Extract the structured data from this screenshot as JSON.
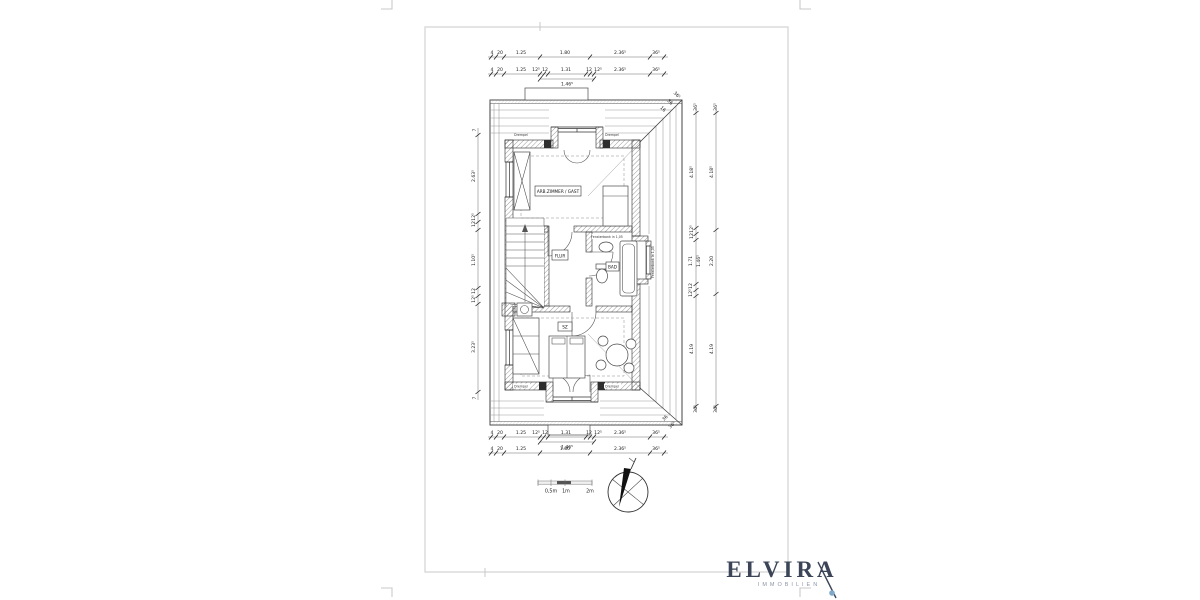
{
  "plan": {
    "rooms": {
      "study": "ARB.ZIMMER / GAST",
      "hall": "FLUR",
      "bath": "BAD",
      "bedroom": "SZ"
    },
    "notes": {
      "sill_top": "Fensterbank in 1,05",
      "sill_right": "Fensterbank in 1,05",
      "knee_top_left": "Drempel",
      "knee_top_right": "Drempel",
      "knee_bottom_left": "Drempel",
      "knee_bottom_right": "Drempel"
    },
    "dims": {
      "top_outer": [
        "4",
        "20",
        "1.25",
        "1.80",
        "2.36⁵",
        "36⁵"
      ],
      "top_inner": [
        "4",
        "20",
        "1.25",
        "12⁵",
        "12",
        "1.31",
        "12",
        "12⁵",
        "2.36⁵",
        "36⁵"
      ],
      "top_sub": "1.46⁵",
      "bottom_inner": [
        "4",
        "20",
        "1.25",
        "12⁵",
        "12",
        "1.31",
        "12",
        "12⁵",
        "2.36⁵",
        "36⁵"
      ],
      "bottom_sub": "1.46⁵",
      "bottom_outer": [
        "4",
        "20",
        "1.25",
        "1.80",
        "2.36⁵",
        "36⁵"
      ],
      "left": [
        "7",
        "2.63⁵",
        "12⁵",
        "12",
        "1.10⁵",
        "12",
        "12⁵",
        "3.23⁵",
        "7"
      ],
      "right_inner": [
        "36⁵",
        "4.18⁵",
        "12⁵",
        "12",
        "1.71",
        "1.46⁵",
        "12",
        "12⁵",
        "4.19",
        "36⁵"
      ],
      "right_outer": [
        "36⁵",
        "4.18⁵",
        "2.20",
        "4.19",
        "36⁵"
      ],
      "hip_top": [
        "16",
        "36",
        "36⁵"
      ],
      "hip_bottom": [
        "36",
        "36⁵"
      ]
    },
    "scalebar": [
      "0,5m",
      "1m",
      "2m"
    ]
  },
  "logo": {
    "title": "ELVIRA",
    "subtitle": "IMMOBILIEN",
    "color": "#3b4557",
    "accent": "#7fa8c9"
  }
}
